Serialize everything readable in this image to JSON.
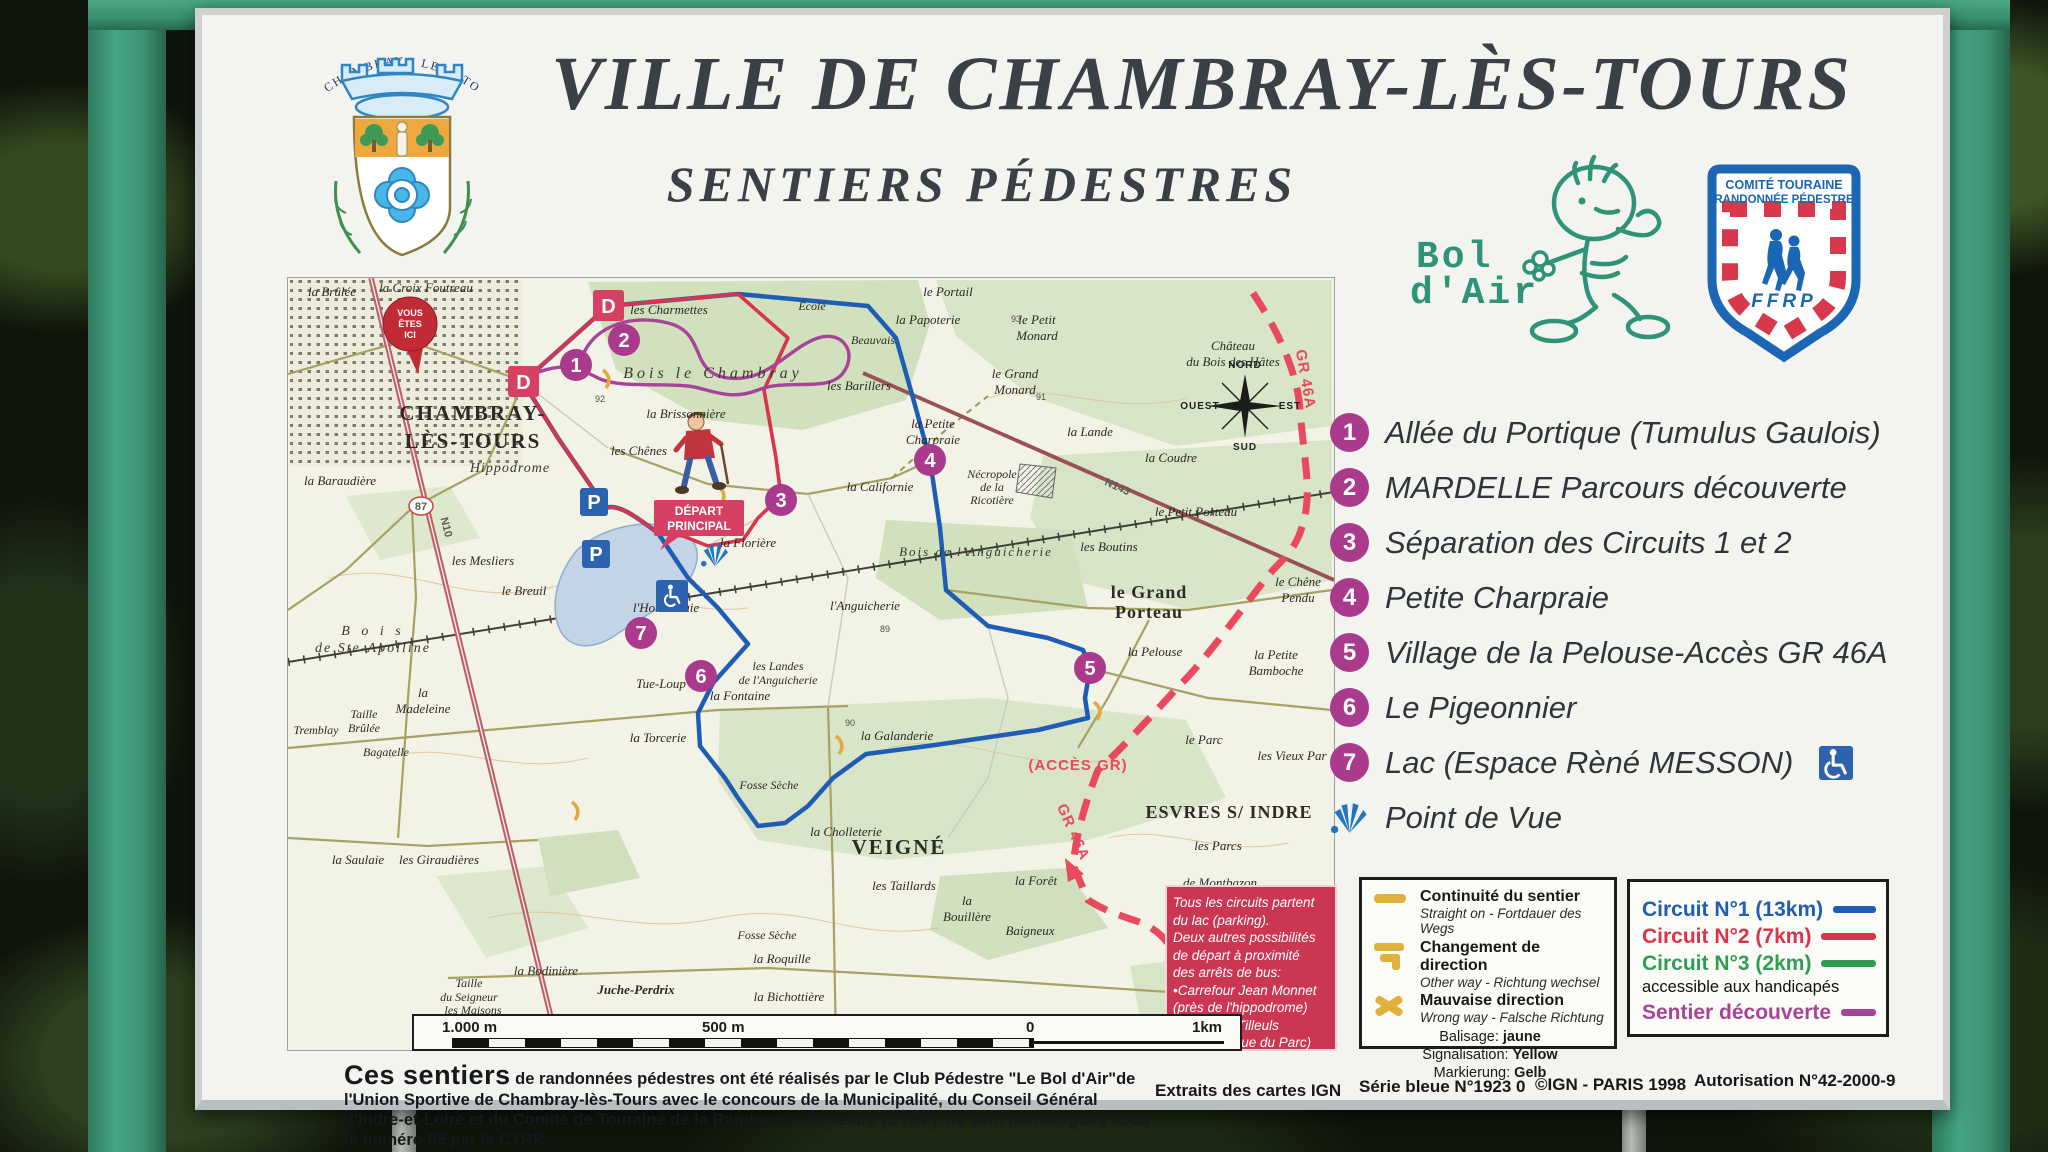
{
  "theme": {
    "waypoint": "#a93a8c",
    "red": "#d64063",
    "blue": "#2c62ae",
    "gr": "#e8495e",
    "green": "#3fa05c",
    "yellow": "#e0b23c",
    "frame_green": "#3f9b7d"
  },
  "header": {
    "title": "VILLE DE CHAMBRAY-LÈS-TOURS",
    "subtitle": "SENTIERS PÉDESTRES",
    "crest_arc_text": "CHAMBRAY - LES - TOURS",
    "bol_dair": {
      "line1": "Bol",
      "line2": "d'Air"
    },
    "ffrp": {
      "band1": "COMITÉ TOURAINE",
      "band2": "RANDONNÉE PÉDESTRE",
      "acronym": "FFRP"
    }
  },
  "waypoints": [
    {
      "num": "1",
      "label": "Allée du Portique (Tumulus Gaulois)"
    },
    {
      "num": "2",
      "label": "MARDELLE Parcours découverte"
    },
    {
      "num": "3",
      "label": "Séparation des Circuits 1 et 2"
    },
    {
      "num": "4",
      "label": "Petite Charpraie"
    },
    {
      "num": "5",
      "label": "Village de la Pelouse-Accès GR 46A"
    },
    {
      "num": "6",
      "label": "Le Pigeonnier"
    },
    {
      "num": "7",
      "label": "Lac (Espace Rèné MESSON)"
    }
  ],
  "point_de_vue_label": "Point de Vue",
  "legend_signs": {
    "items": [
      {
        "fr": "Continuité du sentier",
        "other": "Straight on - Fortdauer des Wegs"
      },
      {
        "fr": "Changement de direction",
        "other": "Other way - Richtung wechsel"
      },
      {
        "fr": "Mauvaise direction",
        "other": "Wrong way - Falsche Richtung"
      }
    ],
    "balisage": [
      {
        "label": "Balisage:",
        "value": "jaune"
      },
      {
        "label": "Signalisation:",
        "value": "Yellow"
      },
      {
        "label": "Markierung:",
        "value": "Gelb"
      }
    ]
  },
  "legend_circuits": {
    "items": [
      {
        "label": "Circuit N°1 (13km)",
        "color": "#1f5db4"
      },
      {
        "label": "Circuit N°2 (7km)",
        "color": "#d8344a"
      },
      {
        "label": "Circuit N°3 (2km)",
        "color": "#2f9e54"
      },
      {
        "label": "Sentier découverte",
        "color": "#a8439a"
      }
    ],
    "note": "accessible aux handicapés"
  },
  "info_box": {
    "lines": [
      "Tous les circuits partent",
      "du lac (parking).",
      "Deux autres possibilités",
      "de départ à proximité",
      "des arrêts de bus:",
      "•Carrefour Jean Monnet",
      " (près de l'hippodrome)",
      "•Allée des Tilleuls",
      " (près Clinique du Parc)"
    ]
  },
  "scale_bar": {
    "l1000": "1.000 m",
    "l500": "500 m",
    "l0": "0",
    "l1km": "1km"
  },
  "credits": {
    "lead": "Ces sentiers",
    "body": " de randonnées pédestres ont été réalisés par le Club Pédestre \"Le Bol d'Air\"de l'Union Sportive de Chambray-lès-Tours avec le concours de la Municipalité, du Conseil Général d'Indre-et-Loire et du Comité de Touraine de la Randonnée Pédestre (CTRP). Ils sont homologués sous le numéro 85 par le CTRP.",
    "extraits": "Extraits des cartes IGN",
    "serie": "Série bleue N°1923 0",
    "ign": "©IGN - PARIS 1998",
    "autorisation": "Autorisation N°42-2000-9"
  },
  "map": {
    "markers": {
      "d": "D",
      "p": "P",
      "vei_1": "VOUS",
      "vei_2": "ÊTES",
      "vei_3": "ICI",
      "depart_1": "DÉPART",
      "depart_2": "PRINCIPAL",
      "acces_gr": "(ACCÈS GR)",
      "gr46a": "GR 46A"
    },
    "compass": {
      "n": "NORD",
      "s": "SUD",
      "e": "EST",
      "o": "OUEST"
    },
    "roads": {
      "n10": "N10",
      "n143": "N143",
      "d87": "87"
    },
    "spots": [
      "92",
      "93",
      "90",
      "89",
      "91"
    ],
    "labels": {
      "croix_foutreau": "la Croix Foutreau",
      "brulee": "la Brûlée",
      "ecole": "École",
      "portail": "le Portail",
      "papoterie": "la Papoterie",
      "beauvais": "Beauvais",
      "petit_monard_1": "le Petit",
      "petit_monard_2": "Monard",
      "grand_monard_1": "le Grand",
      "grand_monard_2": "Monard",
      "chateau_1": "Château",
      "chateau_2": "du Bois des Hâtes",
      "lande": "la Lande",
      "coudre": "la Coudre",
      "petit_porteau": "le Petit Porteau",
      "boutins": "les Boutins",
      "grand_porteau_1": "le Grand",
      "grand_porteau_2": "Porteau",
      "chene_pendu_1": "le Chêne",
      "chene_pendu_2": "Pendu",
      "petite_bamboche_1": "la Petite",
      "petite_bamboche_2": "Bamboche",
      "pelouse": "la Pelouse",
      "parc": "le Parc",
      "vieux_parc": "les Vieux Par",
      "charmettes": "les Charmettes",
      "bois_chambray": "Bois le Chambray",
      "brissonniere": "la Brissonnière",
      "chenes": "les Chênes",
      "chambray_1": "CHAMBRAY-",
      "chambray_2": "LÈS-TOURS",
      "hippodrome": "Hippodrome",
      "mesliers": "les Mesliers",
      "breuil": "le Breuil",
      "barillers": "les Barillers",
      "petite_charpraie_1": "la Petite",
      "petite_charpraie_2": "Charpraie",
      "californie": "la Californie",
      "necropole_1": "Nécropole",
      "necropole_2": "de la",
      "necropole_3": "Ricotière",
      "bois_anguicherie": "Bois de l'Anguicherie",
      "anguicherie": "l'Anguicherie",
      "landes_1": "les Landes",
      "landes_2": "de l'Anguicherie",
      "tue_loup": "Tue-Loup",
      "floriere": "la Florière",
      "hommelaie": "l'Hommelaie",
      "madeleine_1": "la",
      "madeleine_2": "Madeleine",
      "ste_apolline_1": "B o i s",
      "ste_apolline_2": "de Ste-Apolline",
      "baraudiere": "la Baraudière",
      "torcerie": "la Torcerie",
      "fontaine": "la Fontaine",
      "galanderie": "la Galanderie",
      "cholleterie": "la Cholleterie",
      "veigne": "VEIGNÉ",
      "taillards": "les Taillards",
      "fosse_seche": "Fosse Sèche",
      "bouillere_1": "la",
      "bouillere_2": "Bouillère",
      "foret": "la Forêt",
      "baigneux": "Baigneux",
      "roquille": "la Roquille",
      "esvres": "ESVRES S/ INDRE",
      "parcs": "les Parcs",
      "montbazon": "de Montbazon",
      "saulaie": "la Saulaie",
      "giraudieres": "les Giraudières",
      "taille_brulee_1": "Taille",
      "taille_brulee_2": "Brûlée",
      "tremblay": "Tremblay",
      "bagatelle": "Bagatelle",
      "taille_seigneur_1": "Taille",
      "taille_seigneur_2": "du Seigneur",
      "bodiniere": "la Bodinière",
      "juche_perdrix": "Juche-Perdrix",
      "bichottiere": "la Bichottière",
      "maisons": "les Maisons"
    }
  }
}
